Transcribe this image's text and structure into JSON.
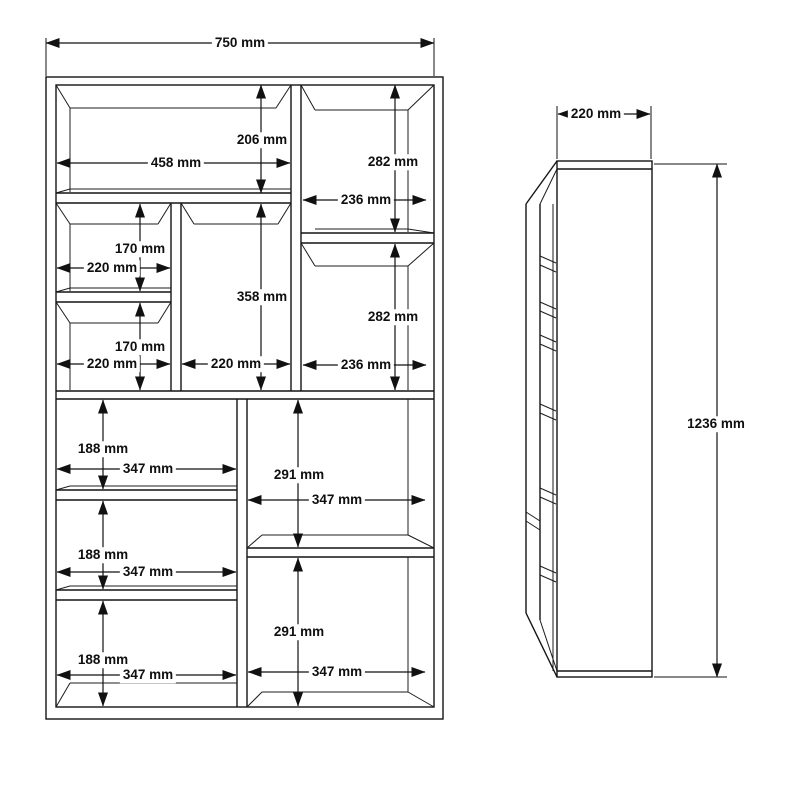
{
  "dims": {
    "front": {
      "overall_width": "750 mm",
      "top_left_height": "206 mm",
      "top_left_width": "458 mm",
      "top_right_upper_height": "282 mm",
      "top_right_upper_width": "236 mm",
      "left_cell1_height": "170 mm",
      "left_cell1_width": "220 mm",
      "left_cell2_height": "170 mm",
      "left_cell2_width": "220 mm",
      "middle_cell_height": "358 mm",
      "middle_cell_width": "220 mm",
      "top_right_lower_height": "282 mm",
      "top_right_lower_width": "236 mm",
      "lower_left_cell1_height": "188 mm",
      "lower_left_cell1_width": "347 mm",
      "lower_right_cell1_height": "291 mm",
      "lower_right_cell1_width": "347 mm",
      "lower_left_cell2_height": "188 mm",
      "lower_left_cell2_width": "347 mm",
      "lower_left_cell3_height": "188 mm",
      "lower_left_cell3_width": "347 mm",
      "lower_right_cell2_height": "291 mm",
      "lower_right_cell2_width": "347 mm"
    },
    "side": {
      "depth": "220 mm",
      "overall_height": "1236 mm"
    }
  }
}
